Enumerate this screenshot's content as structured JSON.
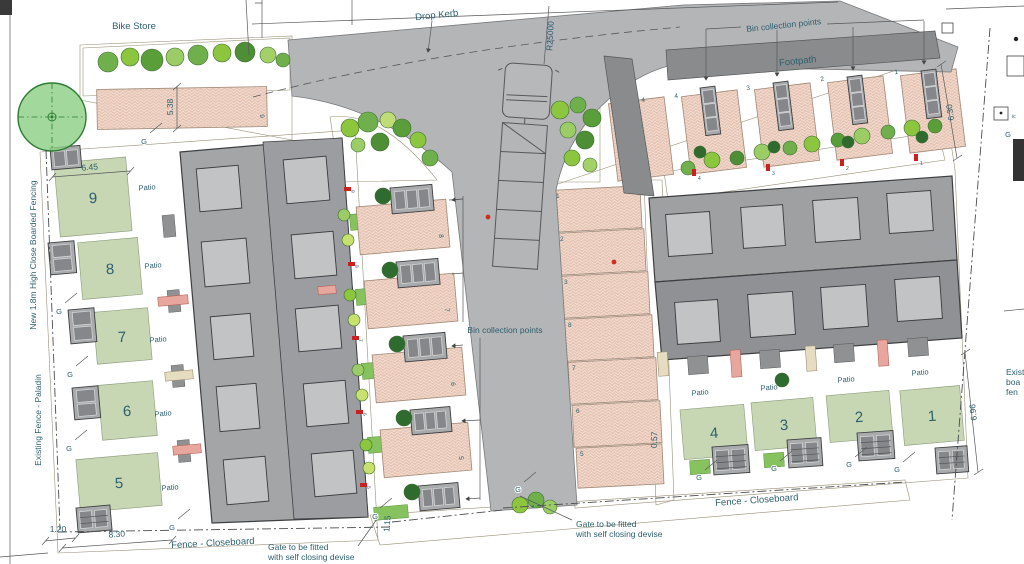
{
  "labels": {
    "bike_store": "Bike Store",
    "drop_kerb": "Drop Kerb",
    "radius": "R25000",
    "footpath": "Footpath",
    "bin_collection_points": "Bin collection points",
    "fence_closeboard": "Fence - Closeboard",
    "gate_note_line1": "Gate to be fitted",
    "gate_note_line2": "with self closing devise",
    "fence_new": "New 1.8m High Close Boarded Fencing",
    "fence_existing": "Existing Fence - Paladin",
    "existing_fence_right_1": "Exist",
    "existing_fence_right_2": "boa",
    "existing_fence_right_3": "fen",
    "patio": "Patio",
    "gate": "G",
    "ic": "ic"
  },
  "dimensions": {
    "garden_width": "6.45",
    "garden_depth": "8.30",
    "store_width": "1.20",
    "parking_width": "5.38",
    "gate_width": "1.15",
    "path_width": "0.57",
    "plot_depth_top": "6.30",
    "plot_depth_bottom": "6.96"
  },
  "plots": {
    "left": [
      "9",
      "8",
      "7",
      "6",
      "5"
    ],
    "right": [
      "4",
      "3",
      "2",
      "1"
    ]
  },
  "parking": {
    "top_left_space": "9",
    "left_column": [
      "8",
      "7",
      "6",
      "5"
    ],
    "central_column": [
      "1",
      "2",
      "3",
      "8",
      "7",
      "6",
      "5"
    ],
    "top_row": [
      "4",
      "4",
      "3",
      "2",
      "1"
    ]
  },
  "markers": {
    "left_column": [
      "9",
      "8",
      "7",
      "6",
      "5"
    ],
    "top_row": [
      "4",
      "3",
      "2",
      "1"
    ]
  },
  "colors": {
    "road": "#b4b5b7",
    "footpath": "#8a8b8d",
    "building_light": "#a3a5a7",
    "building_dark": "#8f9194",
    "skylight": "#c1c3c5",
    "parking_base": "#e5c2b1",
    "garden": "#c7d7b3",
    "beige": "#eae1c6",
    "lawn": "#86c25e",
    "label_text": "#2d5f6d",
    "marker_red": "#cc2020"
  }
}
